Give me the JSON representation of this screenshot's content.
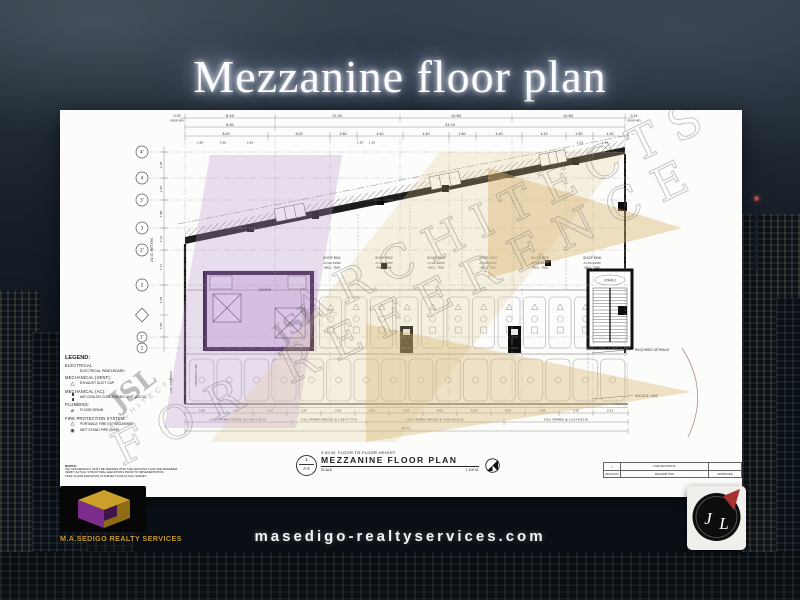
{
  "page": {
    "title": "Mezzanine floor plan",
    "website": "masedigo-realtyservices.com"
  },
  "branding": {
    "company": "M.A.SEDIGO REALTY SERVICES",
    "monogram_j": "J",
    "monogram_l": "L"
  },
  "watermarks": {
    "architects": "ARCHITECTS",
    "reference": "FOR REFERENCE",
    "firm": "JSL",
    "firm_sub": "ARCHITECTS"
  },
  "colors": {
    "gold": "#d4a017",
    "purple": "#7b2d8b",
    "logo_red": "#a83232"
  },
  "plan": {
    "meters_label": "24.00 METERS",
    "property_line_label": "PROPERTY LINE",
    "setback_dim": "4.00 (SETBACK)",
    "grid_bubbles": [
      "4'",
      "4",
      "3'",
      "3",
      "2'",
      "2",
      "1'",
      "1"
    ],
    "top_dims_row1": [
      "0.25",
      "8.40",
      "12.00",
      "10.80",
      "10.80",
      "0.25"
    ],
    "row1_note_left": "(ROW WP)",
    "row1_note_right": "(ROW WP)",
    "top_dims_row2": [
      "8.80",
      "33.20"
    ],
    "top_dims_row3": [
      "8.00",
      "6.00",
      "2.60",
      "4.40",
      "4.40",
      "2.60",
      "4.40",
      "4.25",
      "2.60",
      "4.50"
    ],
    "top_dims_row4": [
      "1.88",
      "2.60",
      "3.30",
      "1.30",
      "1.30",
      "1.50",
      "1.45"
    ],
    "left_dims": [
      "2.38",
      "2.65",
      "2.88",
      "3.12",
      "3.71",
      "5.00",
      "3.00"
    ],
    "shops": [
      {
        "name": "SHOP M01",
        "area": "A=40.70SM",
        "note": "(INCL. T&B)"
      },
      {
        "name": "SHOP M02",
        "area": "A=40.70SM",
        "note": "(INCL. T&B)"
      },
      {
        "name": "SHOP M03",
        "area": "A=41.80SM",
        "note": "(INCL. T&B)"
      },
      {
        "name": "SHOP M04",
        "area": "A=54.32SM",
        "note": "(INCL. T&B)"
      },
      {
        "name": "SHOP M05",
        "area": "A=56.46SM",
        "note": "(INCL. T&B)"
      },
      {
        "name": "SHOP M06",
        "area": "A=54.92SM",
        "note": "(INCL. T&B)"
      }
    ],
    "admin_label": "ADMIN",
    "stair_label": "STAIR-2",
    "callout_setback": "REQUIRED SETBACK",
    "callout_arcade": "ARCADE LINE",
    "bottom_dims": [
      "3.85",
      "3.85",
      "3.87",
      "3.87",
      "3.06",
      "4.05",
      "4.05",
      "4.05",
      "4.05",
      "4.05",
      "3.88",
      "3.25",
      "3.31"
    ],
    "frame_notes": [
      "2 EQ. FRAMES SPACED @ 3.65=7.30 M.",
      "3 EQ. FRAMES SPACED @ 2.58=7.75 M.",
      "5 EQ. FRAMES SPACED @ 4.05=20.25 M.",
      "3 EQ. FRAMES @ 3.31=9.92 M."
    ],
    "total_length": "54.71"
  },
  "legend": {
    "title": "LEGEND:",
    "sections": [
      {
        "heading": "ELECTRICAL",
        "items": [
          {
            "label": "ELECTRICAL PANELBOARD"
          }
        ]
      },
      {
        "heading": "MECHANICAL (VENT):",
        "items": [
          {
            "label": "EXHAUST DUCT CAP"
          }
        ]
      },
      {
        "heading": "MECHANICAL (AC):",
        "items": [
          {
            "label": "AIR COOLED CONDENSING UNIT (ACCU)"
          }
        ]
      },
      {
        "heading": "PLUMBING:",
        "items": [
          {
            "label": "FLOOR DRAIN"
          }
        ]
      },
      {
        "heading": "FIRE PROTECTION SYSTEM:",
        "items": [
          {
            "label": "PORTABLE FIRE EXTINGUISHER"
          },
          {
            "label": "WET STAND PIPE (WSP)"
          }
        ]
      }
    ],
    "notes_title": "NOTES:",
    "notes": [
      "ANY DISCREPANCY MUST BE VERIFIED WITH THE ARCHITECT AND THE ENGINEER.",
      "VERIFY ACTUAL STRUCTURAL ELEVATIONS PRIOR TO IMPLEMENTATION.",
      "FINAL FLOOR ELEVATION IS SUBJECT FOR ACTUAL SURVEY."
    ]
  },
  "titleblock": {
    "detail_no": "1",
    "sheet_no": "A-4",
    "height_note": "3.50 M. FLOOR TO FLOOR HEIGHT",
    "title": "MEZZANINE FLOOR PLAN",
    "scale_label": "SCALE",
    "scale_value": "1:100 M."
  },
  "revisions": {
    "label": "FOR REVISIONS",
    "col_rev": "REVISION",
    "col_desc": "DESCRIPTION",
    "col_appr": "APPROVED"
  }
}
